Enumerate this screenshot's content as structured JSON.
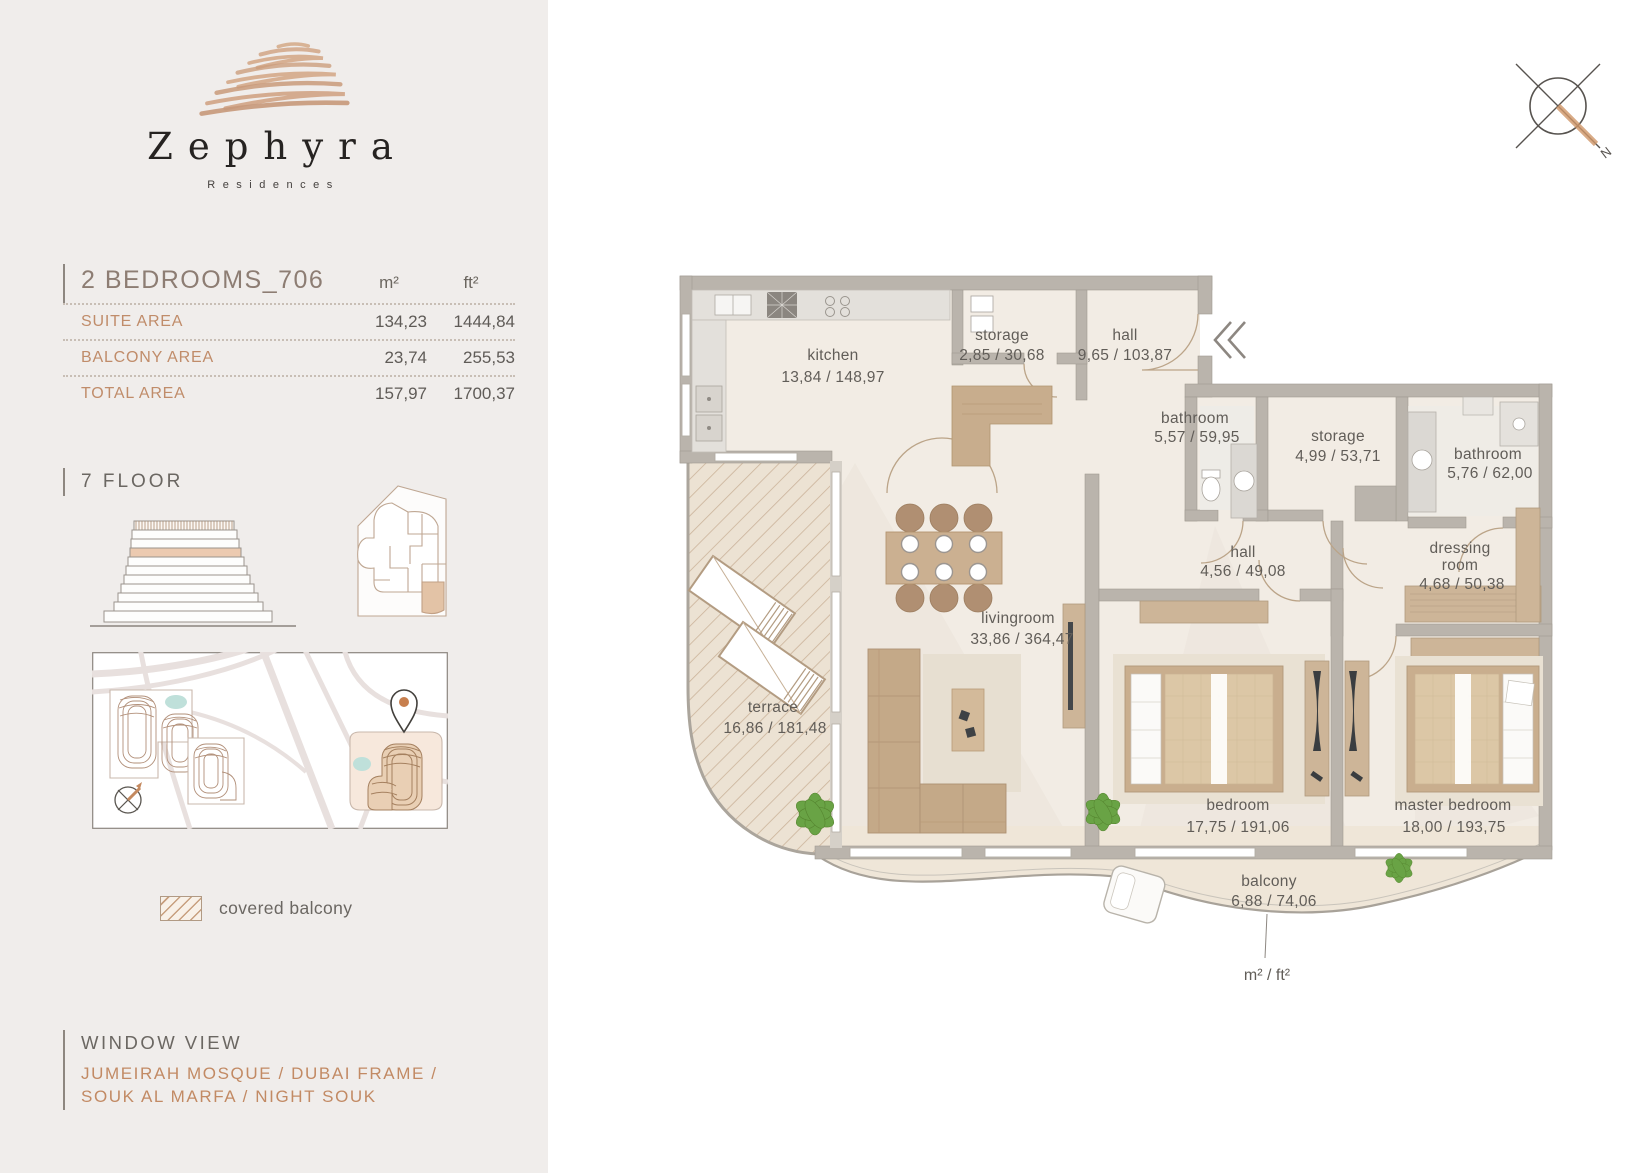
{
  "logo": {
    "name": "Zephyra",
    "subtitle": "Residences"
  },
  "compass": {
    "north_label": "N"
  },
  "unit": {
    "title": "2 BEDROOMS_706",
    "col_m2": "m²",
    "col_ft2": "ft²",
    "rows": [
      {
        "label": "SUITE AREA",
        "m2": "134,23",
        "ft2": "1444,84"
      },
      {
        "label": "BALCONY AREA",
        "m2": "23,74",
        "ft2": "255,53"
      },
      {
        "label": "TOTAL AREA",
        "m2": "157,97",
        "ft2": "1700,37"
      }
    ]
  },
  "floor": {
    "label": "7 FLOOR"
  },
  "legend": {
    "covered_balcony": "covered balcony"
  },
  "window_view": {
    "title": "WINDOW VIEW",
    "line1": "JUMEIRAH MOSQUE / DUBAI FRAME /",
    "line2": "SOUK AL MARFA / NIGHT SOUK"
  },
  "plan": {
    "unit_note": "m² / ft²",
    "rooms": {
      "kitchen": {
        "label": "kitchen",
        "area": "13,84 / 148,97"
      },
      "storage_top": {
        "label": "storage",
        "area": "2,85 / 30,68"
      },
      "hall_top": {
        "label": "hall",
        "area": "9,65 / 103,87"
      },
      "bathroom_1": {
        "label": "bathroom",
        "area": "5,57 / 59,95"
      },
      "storage_2": {
        "label": "storage",
        "area": "4,99 / 53,71"
      },
      "bathroom_2": {
        "label": "bathroom",
        "area": "5,76 / 62,00"
      },
      "hall_2": {
        "label": "hall",
        "area": "4,56 / 49,08"
      },
      "dressing": {
        "label_line1": "dressing",
        "label_line2": "room",
        "area": "4,68 / 50,38"
      },
      "livingroom": {
        "label": "livingroom",
        "area": "33,86 / 364,47"
      },
      "terrace": {
        "label": "terrace",
        "area": "16,86 / 181,48"
      },
      "bedroom": {
        "label": "bedroom",
        "area": "17,75 / 191,06"
      },
      "master_bedroom": {
        "label": "master bedroom",
        "area": "18,00 / 193,75"
      },
      "balcony": {
        "label": "balcony",
        "area": "6,88 / 74,06"
      }
    }
  },
  "colors": {
    "accent_tan": "#c08c6a",
    "floor_highlight": "#eccab0",
    "wall_gray": "#bab4ac",
    "pin_orange": "#c77f4e",
    "plant_green": "#69a345",
    "pond_teal": "#bfe0da"
  }
}
